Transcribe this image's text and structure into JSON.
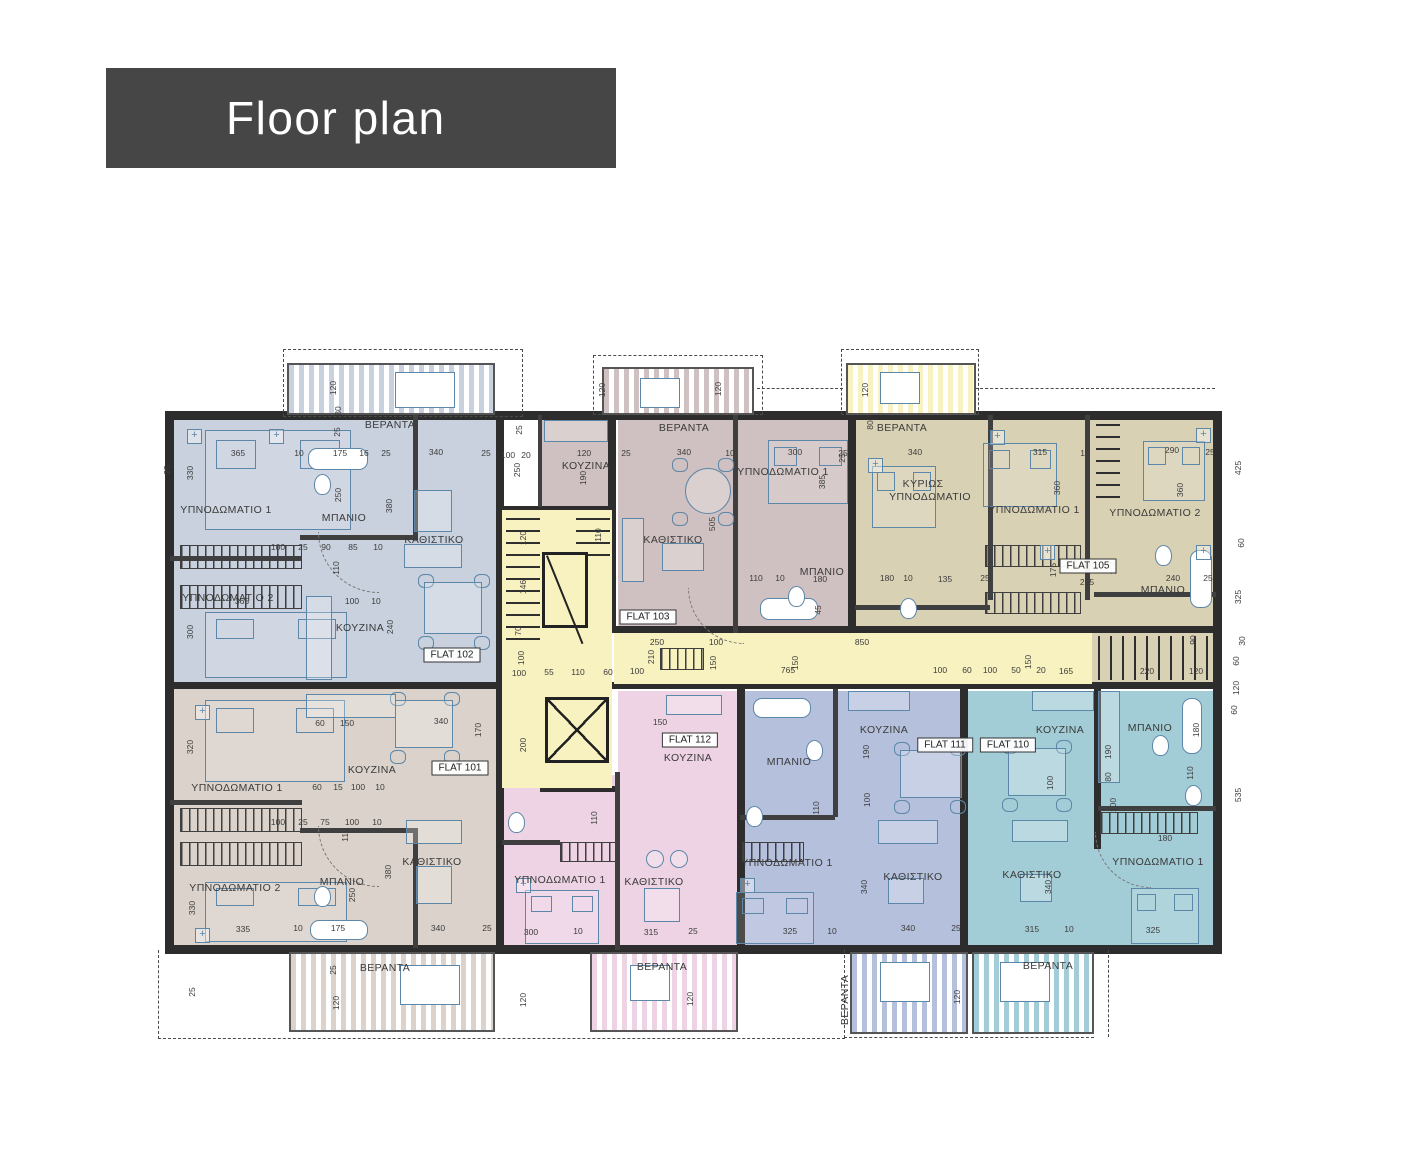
{
  "title": "Floor plan",
  "colors": {
    "titleBg": "#464646",
    "titleText": "#ffffff",
    "wall": "#2d2d2d",
    "dimtext": "#3c3c3c",
    "furn": "#5d87a8",
    "corridor": "#f7f2c0",
    "flat101": "#dad2cb",
    "flat102": "#c8d1dd",
    "flat103": "#cfc1c1",
    "flat105": "#d8d1b4",
    "flat110": "#a3cdd6",
    "flat111": "#b5c0dc",
    "flat112": "#eed3e4"
  },
  "rooms": {
    "bedroom1": "ΥΠΝΟΔΩΜΑΤΙΟ 1",
    "bedroom2": "ΥΠΝΟΔΩΜΑΤΙΟ 2",
    "master1": "ΚΥΡΙΩΣ",
    "master2": "ΥΠΝΟΔΩΜΑΤΙΟ",
    "living": "ΚΑΘΙΣΤΙΚΟ",
    "kitchen": "ΚΟΥΖΙΝΑ",
    "bathroom": "ΜΠΑΝΙΟ",
    "veranda": "ΒΕΡΑΝΤΑ"
  },
  "flats": {
    "f101": "FLAT 101",
    "f102": "FLAT 102",
    "f103": "FLAT 103",
    "f105": "FLAT 105",
    "f110": "FLAT 110",
    "f111": "FLAT 111",
    "f112": "FLAT 112"
  },
  "dims": {
    "d10": "10",
    "d15": "15",
    "d16": "16",
    "d20": "20",
    "d25": "25",
    "d30": "30",
    "d45": "45",
    "d50": "50",
    "d55": "55",
    "d60": "60",
    "d70": "70",
    "d75": "75",
    "d80": "80",
    "d85": "85",
    "d90": "90",
    "d100": "100",
    "d110": "110",
    "d115": "115",
    "d120": "120",
    "d135": "135",
    "d146": "146",
    "d150": "150",
    "d165": "165",
    "d170": "170",
    "d175": "175",
    "d180": "180",
    "d190": "190",
    "d200": "200",
    "d210": "210",
    "d220": "220",
    "d240": "240",
    "d250": "250",
    "d255": "255",
    "d290": "290",
    "d300": "300",
    "d315": "315",
    "d320": "320",
    "d325": "325",
    "d330": "330",
    "d335": "335",
    "d340": "340",
    "d360": "360",
    "d365": "365",
    "d380": "380",
    "d385": "385",
    "d425": "425",
    "d505": "505",
    "d535": "535",
    "d765": "765",
    "d850": "850"
  }
}
